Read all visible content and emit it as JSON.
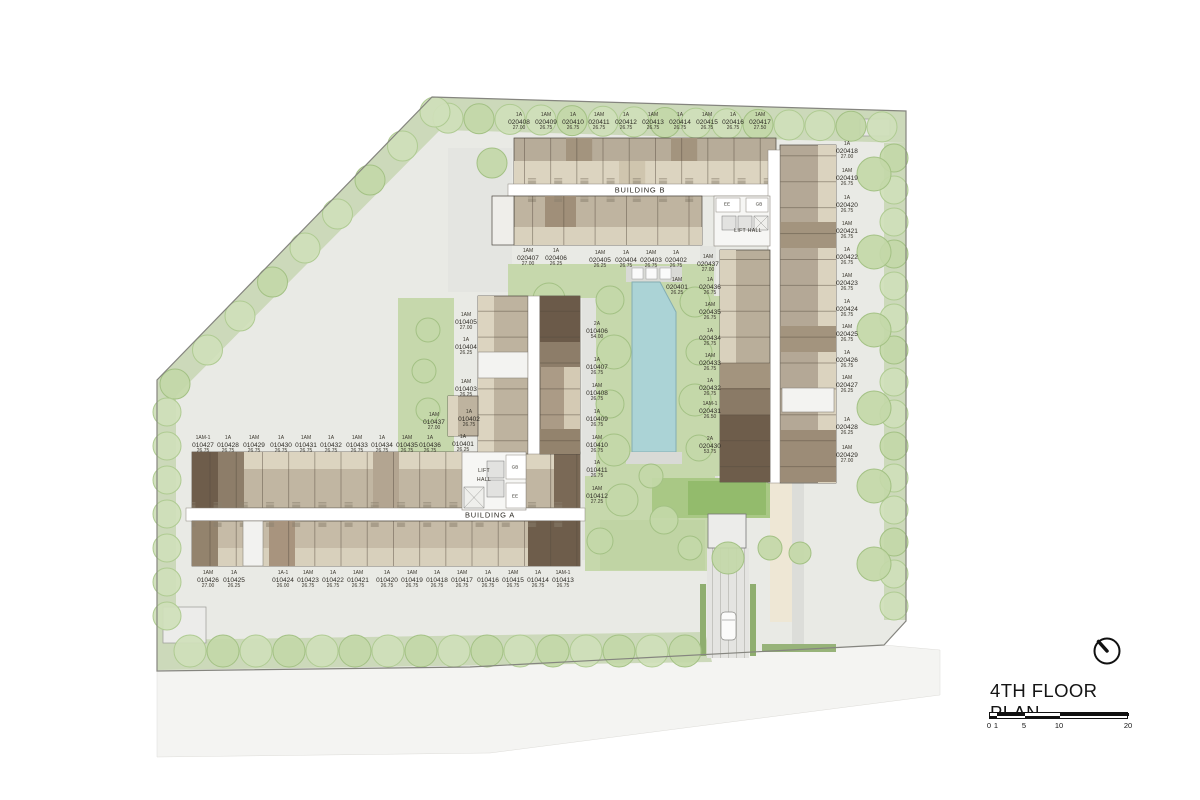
{
  "title_block": {
    "title": "4TH FLOOR PLAN",
    "ticks": [
      {
        "text": "0",
        "x": 0
      },
      {
        "text": "1",
        "x": 7
      },
      {
        "text": "5",
        "x": 35
      },
      {
        "text": "10",
        "x": 70
      },
      {
        "text": "20",
        "x": 139
      }
    ]
  },
  "plan_labels": [
    {
      "text": "BUILDING B",
      "x": 640,
      "y": 190,
      "cls": "bldg"
    },
    {
      "text": "BUILDING A",
      "x": 490,
      "y": 515,
      "cls": "bldg"
    },
    {
      "text": "LIFT HALL",
      "x": 748,
      "y": 231,
      "cls": "room"
    },
    {
      "text": "LIFT",
      "x": 484,
      "y": 471,
      "cls": "room"
    },
    {
      "text": "HALL",
      "x": 484,
      "y": 480,
      "cls": "room"
    },
    {
      "text": "EE",
      "x": 727,
      "y": 204,
      "cls": "tiny"
    },
    {
      "text": "GB",
      "x": 759,
      "y": 204,
      "cls": "tiny"
    },
    {
      "text": "GB",
      "x": 515,
      "y": 467,
      "cls": "tiny"
    },
    {
      "text": "EE",
      "x": 515,
      "y": 496,
      "cls": "tiny"
    }
  ],
  "units": [
    {
      "t": "1A",
      "n": "020408",
      "a": "27.00",
      "x": 519,
      "y": 113
    },
    {
      "t": "1AM",
      "n": "020409",
      "a": "26.75",
      "x": 546,
      "y": 113
    },
    {
      "t": "1A",
      "n": "020410",
      "a": "26.75",
      "x": 573,
      "y": 113
    },
    {
      "t": "1AM",
      "n": "020411",
      "a": "26.75",
      "x": 599,
      "y": 113
    },
    {
      "t": "1A",
      "n": "020412",
      "a": "26.75",
      "x": 626,
      "y": 113
    },
    {
      "t": "1AM",
      "n": "020413",
      "a": "26.75",
      "x": 653,
      "y": 113
    },
    {
      "t": "1A",
      "n": "020414",
      "a": "26.75",
      "x": 680,
      "y": 113
    },
    {
      "t": "1AM",
      "n": "020415",
      "a": "26.75",
      "x": 707,
      "y": 113
    },
    {
      "t": "1A",
      "n": "020416",
      "a": "26.75",
      "x": 733,
      "y": 113
    },
    {
      "t": "1AM",
      "n": "020417",
      "a": "27.50",
      "x": 760,
      "y": 113
    },
    {
      "t": "1A",
      "n": "020418",
      "a": "27.00",
      "x": 847,
      "y": 142
    },
    {
      "t": "1AM",
      "n": "020419",
      "a": "26.75",
      "x": 847,
      "y": 169
    },
    {
      "t": "1A",
      "n": "020420",
      "a": "26.75",
      "x": 847,
      "y": 196
    },
    {
      "t": "1AM",
      "n": "020421",
      "a": "26.75",
      "x": 847,
      "y": 222
    },
    {
      "t": "1A",
      "n": "020422",
      "a": "26.75",
      "x": 847,
      "y": 248
    },
    {
      "t": "1AM",
      "n": "020423",
      "a": "26.75",
      "x": 847,
      "y": 274
    },
    {
      "t": "1A",
      "n": "020424",
      "a": "26.75",
      "x": 847,
      "y": 300
    },
    {
      "t": "1AM",
      "n": "020425",
      "a": "26.75",
      "x": 847,
      "y": 325
    },
    {
      "t": "1A",
      "n": "020426",
      "a": "26.75",
      "x": 847,
      "y": 351
    },
    {
      "t": "1AM",
      "n": "020427",
      "a": "26.25",
      "x": 847,
      "y": 376
    },
    {
      "t": "1A",
      "n": "020428",
      "a": "26.25",
      "x": 847,
      "y": 418
    },
    {
      "t": "1AM",
      "n": "020429",
      "a": "27.00",
      "x": 847,
      "y": 446
    },
    {
      "t": "1AM",
      "n": "020407",
      "a": "27.00",
      "x": 528,
      "y": 249
    },
    {
      "t": "1A",
      "n": "020406",
      "a": "26.25",
      "x": 556,
      "y": 249
    },
    {
      "t": "1AM",
      "n": "020405",
      "a": "26.25",
      "x": 600,
      "y": 251
    },
    {
      "t": "1A",
      "n": "020404",
      "a": "26.75",
      "x": 626,
      "y": 251
    },
    {
      "t": "1AM",
      "n": "020403",
      "a": "26.75",
      "x": 651,
      "y": 251
    },
    {
      "t": "1A",
      "n": "020402",
      "a": "26.75",
      "x": 676,
      "y": 251
    },
    {
      "t": "1AM",
      "n": "020437",
      "a": "27.00",
      "x": 708,
      "y": 255
    },
    {
      "t": "1AM",
      "n": "020401",
      "a": "26.25",
      "x": 677,
      "y": 278
    },
    {
      "t": "1A",
      "n": "020436",
      "a": "26.75",
      "x": 710,
      "y": 278
    },
    {
      "t": "1AM",
      "n": "020435",
      "a": "26.75",
      "x": 710,
      "y": 303
    },
    {
      "t": "1A",
      "n": "020434",
      "a": "26.75",
      "x": 710,
      "y": 329
    },
    {
      "t": "1AM",
      "n": "020433",
      "a": "26.75",
      "x": 710,
      "y": 354
    },
    {
      "t": "1A",
      "n": "020432",
      "a": "26.75",
      "x": 710,
      "y": 379
    },
    {
      "t": "1AM-1",
      "n": "020431",
      "a": "26.50",
      "x": 710,
      "y": 402
    },
    {
      "t": "2A",
      "n": "020430",
      "a": "53.75",
      "x": 710,
      "y": 437
    },
    {
      "t": "1AM",
      "n": "010405",
      "a": "27.00",
      "x": 466,
      "y": 313
    },
    {
      "t": "1A",
      "n": "010404",
      "a": "26.25",
      "x": 466,
      "y": 338
    },
    {
      "t": "1AM",
      "n": "010403",
      "a": "26.25",
      "x": 466,
      "y": 380
    },
    {
      "t": "1AM",
      "n": "010437",
      "a": "27.00",
      "x": 434,
      "y": 413
    },
    {
      "t": "1A",
      "n": "010402",
      "a": "26.75",
      "x": 469,
      "y": 410
    },
    {
      "t": "1A",
      "n": "010401",
      "a": "26.25",
      "x": 463,
      "y": 435
    },
    {
      "t": "1AM-1",
      "n": "010427",
      "a": "26.75",
      "x": 203,
      "y": 436
    },
    {
      "t": "1A",
      "n": "010428",
      "a": "26.75",
      "x": 228,
      "y": 436
    },
    {
      "t": "1AM",
      "n": "010429",
      "a": "26.75",
      "x": 254,
      "y": 436
    },
    {
      "t": "1A",
      "n": "010430",
      "a": "26.75",
      "x": 281,
      "y": 436
    },
    {
      "t": "1AM",
      "n": "010431",
      "a": "26.75",
      "x": 306,
      "y": 436
    },
    {
      "t": "1A",
      "n": "010432",
      "a": "26.75",
      "x": 331,
      "y": 436
    },
    {
      "t": "1AM",
      "n": "010433",
      "a": "26.75",
      "x": 357,
      "y": 436
    },
    {
      "t": "1A",
      "n": "010434",
      "a": "26.75",
      "x": 382,
      "y": 436
    },
    {
      "t": "1AM",
      "n": "010435",
      "a": "26.75",
      "x": 407,
      "y": 436
    },
    {
      "t": "1A",
      "n": "010436",
      "a": "26.75",
      "x": 430,
      "y": 436
    },
    {
      "t": "1AM",
      "n": "010426",
      "a": "27.00",
      "x": 208,
      "y": 571
    },
    {
      "t": "1A",
      "n": "010425",
      "a": "26.25",
      "x": 234,
      "y": 571
    },
    {
      "t": "1A-1",
      "n": "010424",
      "a": "26.00",
      "x": 283,
      "y": 571
    },
    {
      "t": "1AM",
      "n": "010423",
      "a": "26.75",
      "x": 308,
      "y": 571
    },
    {
      "t": "1A",
      "n": "010422",
      "a": "26.75",
      "x": 333,
      "y": 571
    },
    {
      "t": "1AM",
      "n": "010421",
      "a": "26.75",
      "x": 358,
      "y": 571
    },
    {
      "t": "1A",
      "n": "010420",
      "a": "26.75",
      "x": 387,
      "y": 571
    },
    {
      "t": "1AM",
      "n": "010419",
      "a": "26.75",
      "x": 412,
      "y": 571
    },
    {
      "t": "1A",
      "n": "010418",
      "a": "26.75",
      "x": 437,
      "y": 571
    },
    {
      "t": "1AM",
      "n": "010417",
      "a": "26.75",
      "x": 462,
      "y": 571
    },
    {
      "t": "1A",
      "n": "010416",
      "a": "26.75",
      "x": 488,
      "y": 571
    },
    {
      "t": "1AM",
      "n": "010415",
      "a": "26.75",
      "x": 513,
      "y": 571
    },
    {
      "t": "1A",
      "n": "010414",
      "a": "26.75",
      "x": 538,
      "y": 571
    },
    {
      "t": "1AM-1",
      "n": "010413",
      "a": "26.75",
      "x": 563,
      "y": 571
    },
    {
      "t": "2A",
      "n": "010406",
      "a": "54.00",
      "x": 597,
      "y": 322
    },
    {
      "t": "1A",
      "n": "010407",
      "a": "26.75",
      "x": 597,
      "y": 358
    },
    {
      "t": "1AM",
      "n": "010408",
      "a": "26.75",
      "x": 597,
      "y": 384
    },
    {
      "t": "1A",
      "n": "010409",
      "a": "26.75",
      "x": 597,
      "y": 410
    },
    {
      "t": "1AM",
      "n": "010410",
      "a": "26.75",
      "x": 597,
      "y": 436
    },
    {
      "t": "1A",
      "n": "010411",
      "a": "26.75",
      "x": 597,
      "y": 461
    },
    {
      "t": "1AM",
      "n": "010412",
      "a": "27.25",
      "x": 597,
      "y": 487
    }
  ]
}
